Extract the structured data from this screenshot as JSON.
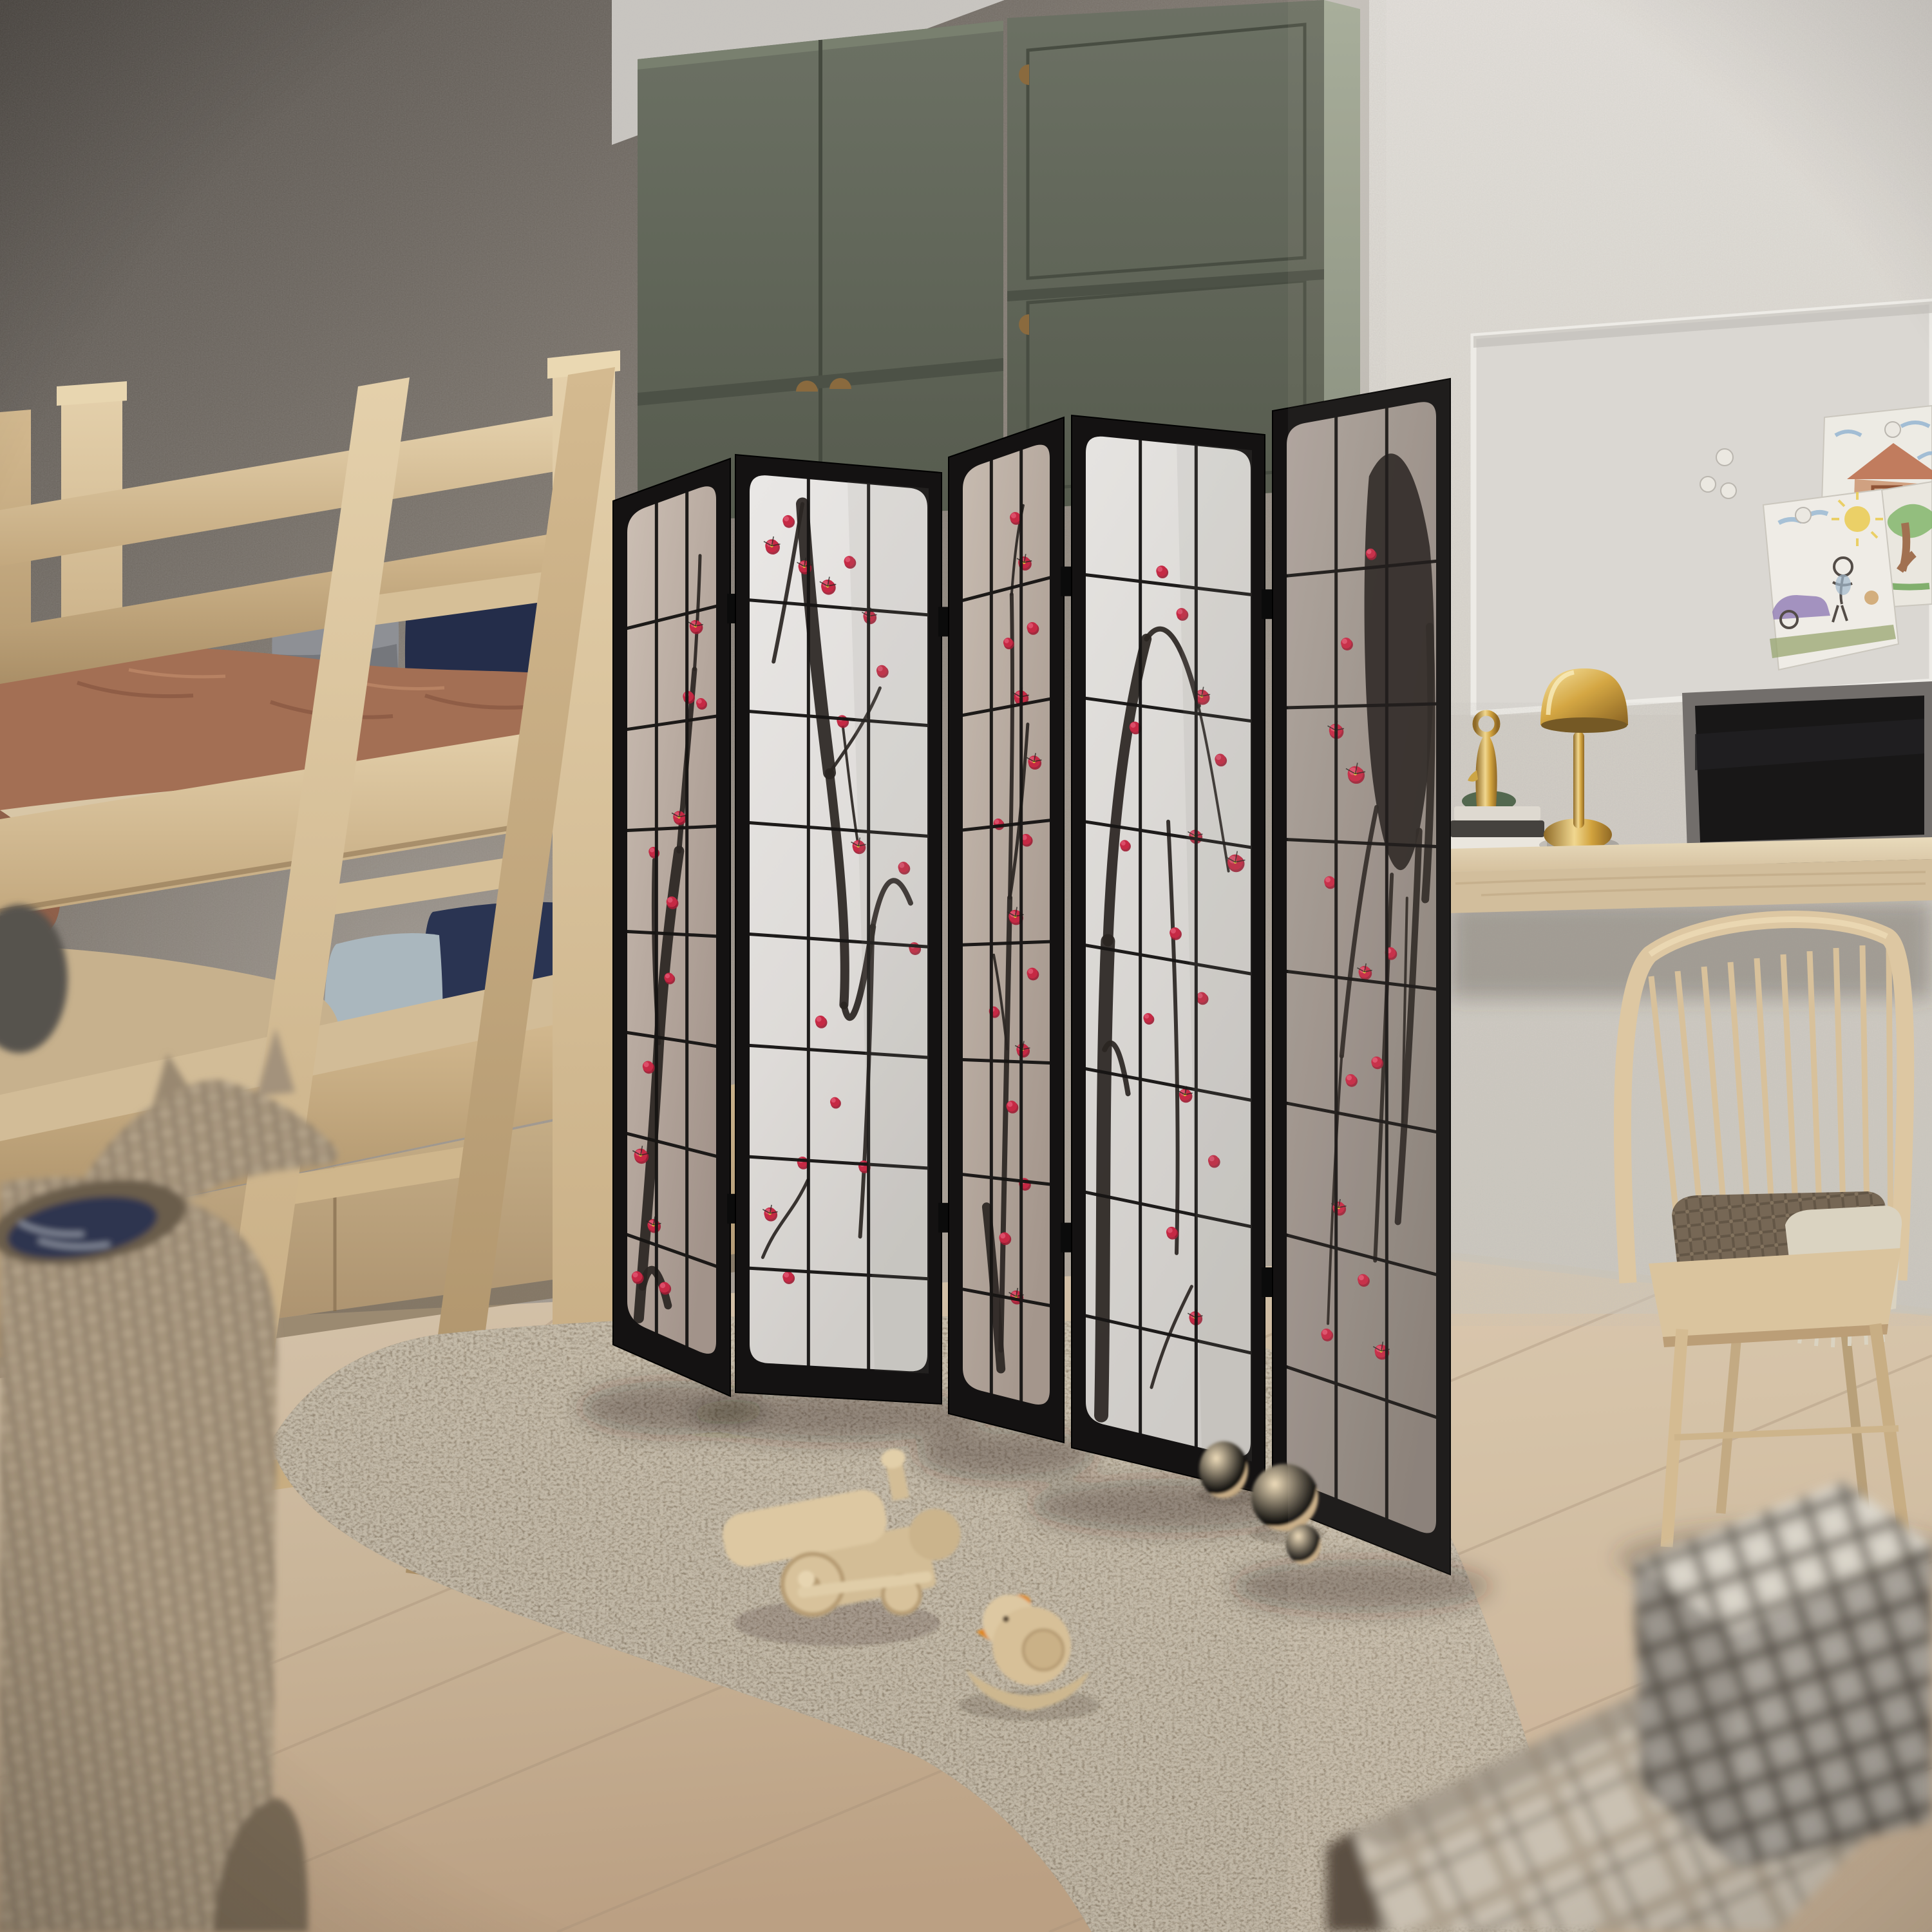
{
  "meta": {
    "domain": "Natural-Image",
    "scene": "photorealistic 3D render of a children's bedroom",
    "style": "scandinavian-japandi kids room, corner view, shallow depth of field"
  },
  "palette": {
    "wall_left_dark": "#55504b",
    "wall_left_mid": "#8a837b",
    "wall_left_light": "#aba294",
    "wall_right": "#dcd8d2",
    "wall_right_low": "#cfccc4",
    "ceiling": "#c9c6c1",
    "floor_light": "#d4c2aa",
    "floor_dark": "#bda78c",
    "floor_seam": "#a8927a",
    "rug_light": "#b3a48d",
    "rug_dark": "#7e705d",
    "wood_light": "#e0cca6",
    "wood_mid": "#cdb38a",
    "wood_dark": "#a88e68",
    "wardrobe_sage": "#616659",
    "wardrobe_sage_dark": "#51564b",
    "wardrobe_side": "#99a08f",
    "handle_wood": "#8a6a3e",
    "screen_frame": "#141212",
    "hinge": "#0b0b0b",
    "muntin": "#161413",
    "pane_bright": "#e7e5e3",
    "pane_bright_low": "#d2cfcb",
    "pane_warm": "#c9bcb1",
    "pane_warm_low": "#a2938a",
    "pane_dark": "#aaa099",
    "pane_dark_low": "#8a817a",
    "ink": "#2a2522",
    "blossom": "#c52944",
    "blossom_light": "#df5570",
    "blossom_deep": "#9f1c33",
    "blossom_core": "#e9c23d",
    "pillow_gray": "#8e9095",
    "pillow_navy": "#242d4a",
    "pillow_navy_low": "#2a3452",
    "pillow_blue": "#aab7be",
    "blanket_terracotta": "#a36f54",
    "blanket_tan": "#c7b18d",
    "mattress_sheet": "#d8c6a6",
    "whiteboard_face": "#d8d6d2",
    "whiteboard_frame": "#ecebe7",
    "paper": "#edebe5",
    "crayon_blue": "#8aafd0",
    "crayon_yellow": "#e9cb52",
    "crayon_purple": "#917cb6",
    "crayon_green": "#6fae58",
    "crayon_brown": "#9c6b4a",
    "crayon_red_brown": "#b5623f",
    "desk_wood": "#dcc9a8",
    "lamp_gold": "#d3a43c",
    "lamp_gold_dark": "#8a621c",
    "lamp_gold_light": "#f7e3a0",
    "laptop_body": "#6b6866",
    "laptop_screen": "#0c0c0d",
    "book_white": "#e9e6df",
    "book_black": "#3c3936",
    "chair_wood": "#dcc6a0",
    "chair_blanket_brown": "#6f604e",
    "chair_throw_cream": "#d9d2c0",
    "wicker": "#a3927c",
    "wicker_dark": "#6e6150",
    "basket_fabric_navy": "#2d3450",
    "gingham_light": "#d7d2c8",
    "gingham_mid": "#a9a296",
    "gingham_dark": "#4b463f",
    "plaid_base": "#c8bfb0",
    "plaid_stripe": "#aa9f8c",
    "box_shadow_face": "#53463a",
    "toy_wood": "#ddc8a2",
    "toy_accent_orange": "#e0851f"
  },
  "room": {
    "left_wall": "textured gray plaster wall",
    "right_wall": "white stucco wall",
    "floor": "light oak plank floor",
    "rug": "taupe shag rug"
  },
  "furniture": {
    "bunk_bed": {
      "label": "light wood bunk bed with leaning ladder and under-bed drawers",
      "bedding": [
        "terracotta knit blanket",
        "navy pillows",
        "gray pillow",
        "light blue pillow",
        "tan blanket"
      ]
    },
    "wardrobe": {
      "label": "sage green two-unit wardrobe",
      "units": 2,
      "handles": "wooden half-moon pulls"
    },
    "room_divider": {
      "label": "5-panel black shoji folding screen",
      "panels": 5,
      "motif": "plum blossom sumi-e ink painting",
      "grid_columns": 3,
      "grid_rows": 8
    },
    "desk": {
      "label": "floating light-wood desk",
      "items": [
        "brass mushroom table lamp",
        "laptop with dark screen",
        "stack of books",
        "small brass figurine"
      ]
    },
    "chair": {
      "label": "spindle-back wooden chair",
      "items": [
        "brown waffle blanket",
        "cream fringed throw"
      ]
    },
    "whiteboard": {
      "label": "wall whiteboard with round magnets",
      "magnets": 5,
      "drawings": [
        "house drawing",
        "tree drawing",
        "family with purple car drawing"
      ]
    },
    "toys": [
      "wooden toy train",
      "wooden rocking bird with orange beak",
      "wooden balls"
    ],
    "baskets": [
      "wicker unicorn-shaped storage basket"
    ],
    "boxes": [
      "plaid and gingham storage cubes"
    ]
  }
}
